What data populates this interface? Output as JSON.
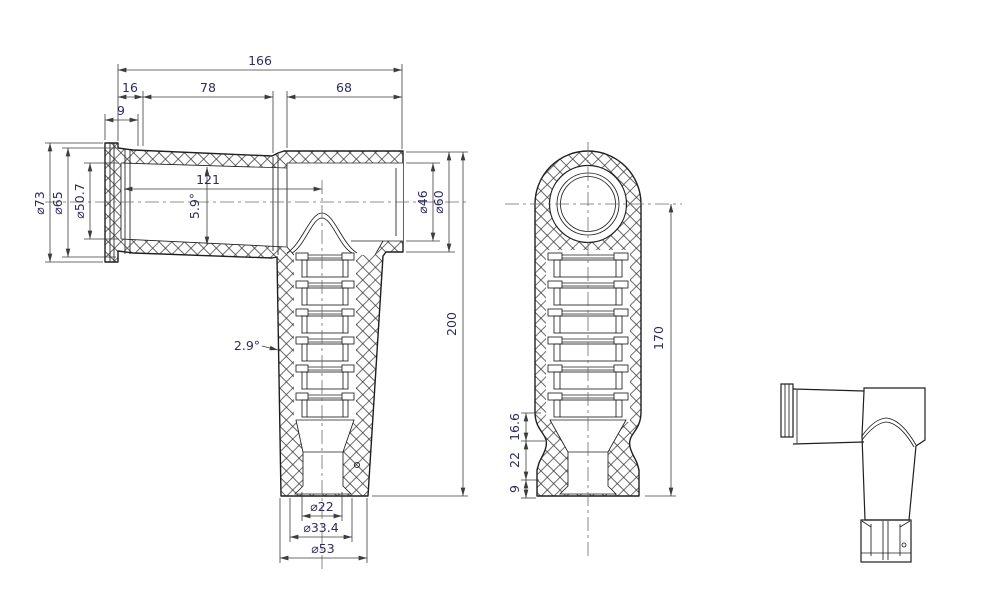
{
  "drawing": {
    "side_section_view": {
      "dims_top": {
        "overall_length": "166",
        "flange_length": "16",
        "taper_length": "78",
        "outlet_length": "68",
        "lip_width": "9"
      },
      "dims_left": {
        "flange_od": "⌀73",
        "neck_od": "⌀65",
        "bore_id": "⌀50.7"
      },
      "dims_middle": {
        "center_distance": "121",
        "bore_taper_angle": "5.9°",
        "body_draft_angle": "2.9°"
      },
      "dims_right": {
        "outlet_id": "⌀46",
        "outlet_od": "⌀60",
        "overall_height": "200"
      },
      "dims_bottom": {
        "tip_bore": "⌀22",
        "tip_flare": "⌀33.4",
        "body_od": "⌀53"
      }
    },
    "front_section_view": {
      "dims_left": {
        "shoulder": "16.6",
        "skirt": "22",
        "lip": "9"
      },
      "dims_right": {
        "height_from_axis": "170"
      }
    },
    "outline_view": {}
  }
}
